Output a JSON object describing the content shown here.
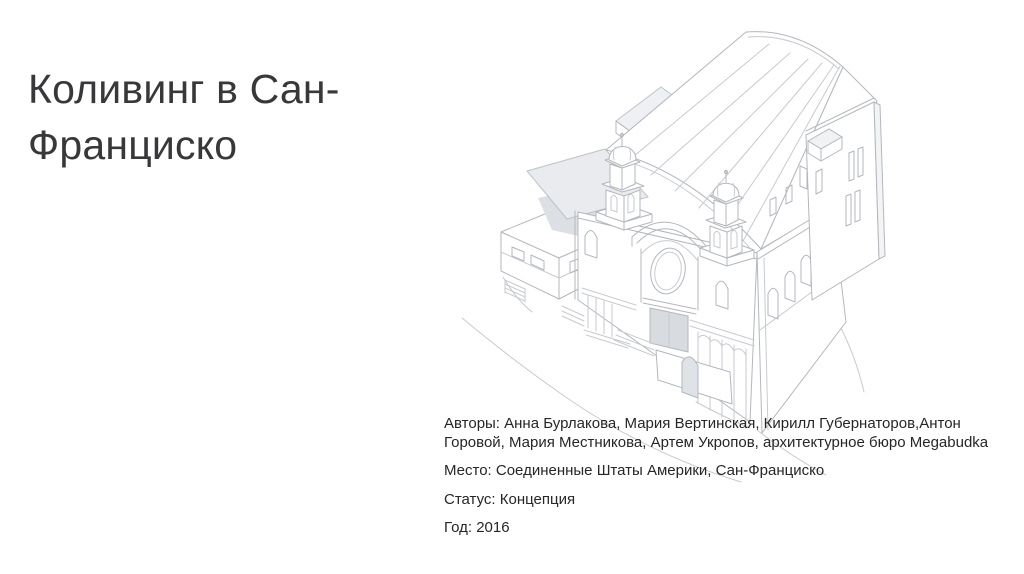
{
  "slide": {
    "title": "Коливинг в Сан-Франциско",
    "info": {
      "authors": "Авторы: Анна Бурлакова, Мария Вертинская, Кирилл Губернаторов,Антон Горовой, Мария Местникова, Артем Укропов, архитектурное бюро Megabudka",
      "place": "Место: Соединенные Штаты Америки, Сан-Франциско",
      "status": "Статус: Концепция",
      "year": "Год: 2016"
    },
    "illustration": {
      "subject": "axonometric line drawing of a church building with two cupola towers"
    },
    "colors": {
      "background": "#ffffff",
      "title_text": "#38383a",
      "body_text": "#262626",
      "drawing_line": "#b3b7bd",
      "drawing_shade": "#dcdfe3"
    }
  }
}
